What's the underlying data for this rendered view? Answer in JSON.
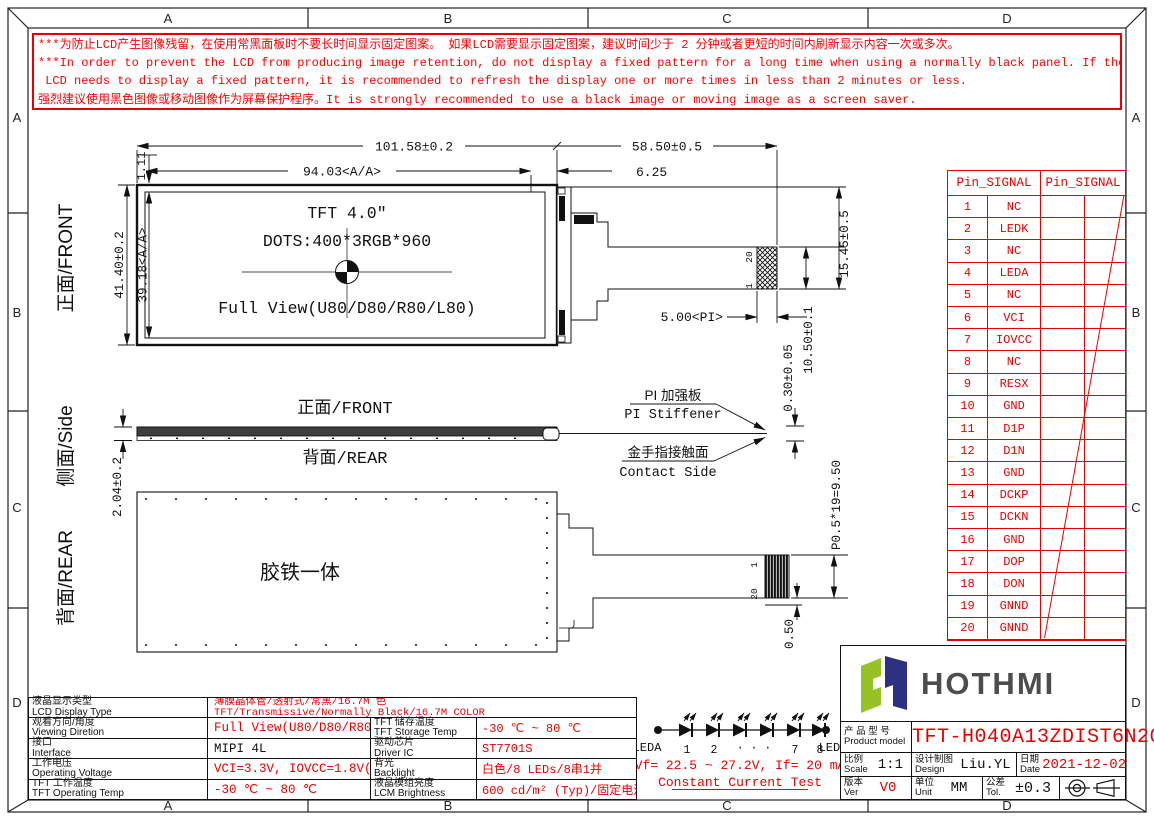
{
  "colors": {
    "red": "#e80000",
    "line": "#111111",
    "logo_green": "#97c226",
    "logo_navy": "#2e3180",
    "logo_text": "#4d4d4d"
  },
  "border": {
    "grid_letters": [
      "A",
      "B",
      "C",
      "D"
    ]
  },
  "warning": {
    "lines": [
      "***为防止LCD产生图像残留，在使用常黑面板时不要长时间显示固定图案。 如果LCD需要显示固定图案，建议时间少于 2 分钟或者更短的时间内刷新显示内容一次或多次。",
      "***In order to prevent the LCD from producing image retention, do not display a fixed pattern for a long time when using a normally black panel. If the",
      " LCD needs to display a fixed pattern, it is recommended to refresh the display one or more times in less than 2 minutes or less.",
      "强烈建议使用黑色图像或移动图像作为屏幕保护程序。It is strongly recommended to use a black image or moving image as a screen saver."
    ]
  },
  "front_view": {
    "side_label": "正面/FRONT",
    "title": "TFT 4.0″",
    "dots": "DOTS:400*3RGB*960",
    "full_view": "Full View(U80/D80/R80/L80)",
    "dims": {
      "width": "101.58±0.2",
      "aa_width": "94.03<A/A>",
      "ledge": "6.25",
      "tail_length": "58.50±0.5",
      "top_margin": "1.11",
      "height": "41.40±0.2",
      "aa_height": "39.18<A/A>",
      "stiffener_width": "5.00<PI>",
      "tail_h1": "15.45±0.5",
      "tail_h2": "10.50±0.1",
      "pin20": "20",
      "pin1": "1"
    }
  },
  "side_view": {
    "side_label": "侧面/Side",
    "front_label": "正面/FRONT",
    "rear_label": "背面/REAR",
    "stiffener_cn": "PI 加强板",
    "stiffener_en": "PI Stiffener",
    "contact_cn": "金手指接触面",
    "contact_en": "Contact Side",
    "dims": {
      "thickness": "2.04±0.2",
      "stiffener_thickness": "0.30±0.05"
    }
  },
  "rear_view": {
    "side_label": "背面/REAR",
    "body_text": "胶铁一体",
    "dims": {
      "pitch": "P0.5*19=9.50",
      "offset": "0.50",
      "pin1": "1",
      "pin20": "20"
    }
  },
  "pin_table": {
    "headers": [
      "Pin_SIGNAL",
      "Pin_SIGNAL"
    ],
    "rows": [
      {
        "pin": "1",
        "signal": "NC"
      },
      {
        "pin": "2",
        "signal": "LEDK"
      },
      {
        "pin": "3",
        "signal": "NC"
      },
      {
        "pin": "4",
        "signal": "LEDA"
      },
      {
        "pin": "5",
        "signal": "NC"
      },
      {
        "pin": "6",
        "signal": "VCI"
      },
      {
        "pin": "7",
        "signal": "IOVCC"
      },
      {
        "pin": "8",
        "signal": "NC"
      },
      {
        "pin": "9",
        "signal": "RESX"
      },
      {
        "pin": "10",
        "signal": "GND"
      },
      {
        "pin": "11",
        "signal": "D1P"
      },
      {
        "pin": "12",
        "signal": "D1N"
      },
      {
        "pin": "13",
        "signal": "GND"
      },
      {
        "pin": "14",
        "signal": "DCKP"
      },
      {
        "pin": "15",
        "signal": "DCKN"
      },
      {
        "pin": "16",
        "signal": "GND"
      },
      {
        "pin": "17",
        "signal": "DOP"
      },
      {
        "pin": "18",
        "signal": "DON"
      },
      {
        "pin": "19",
        "signal": "GNND"
      },
      {
        "pin": "20",
        "signal": "GNND"
      }
    ]
  },
  "spec_table": {
    "rows": [
      {
        "label_cn": "液晶显示类型",
        "label_en": "LCD Display Type",
        "value_line1": "薄膜晶体管/透射式/常黑/16.7M 色",
        "value_line2": "TFT/Transmissive/Normally Black/16.7M COLOR"
      },
      {
        "label_cn": "观看方向/角度",
        "label_en": "Viewing Diretion",
        "value": "Full View(U80/D80/R80/L80)",
        "label2_cn": "TFT 储存温度",
        "label2_en": "TFT Storage Temp",
        "value2": "-30 ℃ ~ 80 ℃"
      },
      {
        "label_cn": "接口",
        "label_en": "Interface",
        "value": "MIPI 4L",
        "label2_cn": "驱动芯片",
        "label2_en": "Driver IC",
        "value2": "ST7701S"
      },
      {
        "label_cn": "工作电压",
        "label_en": "Operating Voltage",
        "value": "VCI=3.3V, IOVCC=1.8V(Typ)",
        "label2_cn": "背光",
        "label2_en": "Backlight",
        "value2": "白色/8 LEDs/8串1并"
      },
      {
        "label_cn": "TFT 工作温度",
        "label_en": "TFT Operating Temp",
        "value": "-30 ℃ ~ 80 ℃",
        "label2_cn": "液晶模组亮度",
        "label2_en": "LCM Brightness",
        "value2": "600 cd/m² (Typ)/固定电流测试"
      }
    ]
  },
  "led_diagram": {
    "anode": "LEDA",
    "cathode": "LEDK",
    "numbers": [
      "1",
      "2",
      "· · ·",
      "7",
      "8"
    ],
    "vf_text": "Vf= 22.5 ~ 27.2V, If= 20 mA",
    "test_text": "Constant Current Test"
  },
  "title_block": {
    "brand": "HOTHMI",
    "product_label_cn": "产 品 型 号",
    "product_label_en": "Product model",
    "product_model": "TFT-H040A13ZDIST6N20",
    "scale_cn": "比例",
    "scale_en": "Scale",
    "scale_value": "1:1",
    "design_cn": "设计制图",
    "design_en": "Design",
    "design_value": "Liu.YL",
    "date_cn": "日期",
    "date_en": "Date",
    "date_value": "2021-12-02",
    "ver_cn": "版本",
    "ver_en": "Ver",
    "ver_value": "V0",
    "unit_cn": "单位",
    "unit_en": "Unit",
    "unit_value": "MM",
    "tol_cn": "公差",
    "tol_en": "Tol.",
    "tol_value": "±0.3"
  }
}
